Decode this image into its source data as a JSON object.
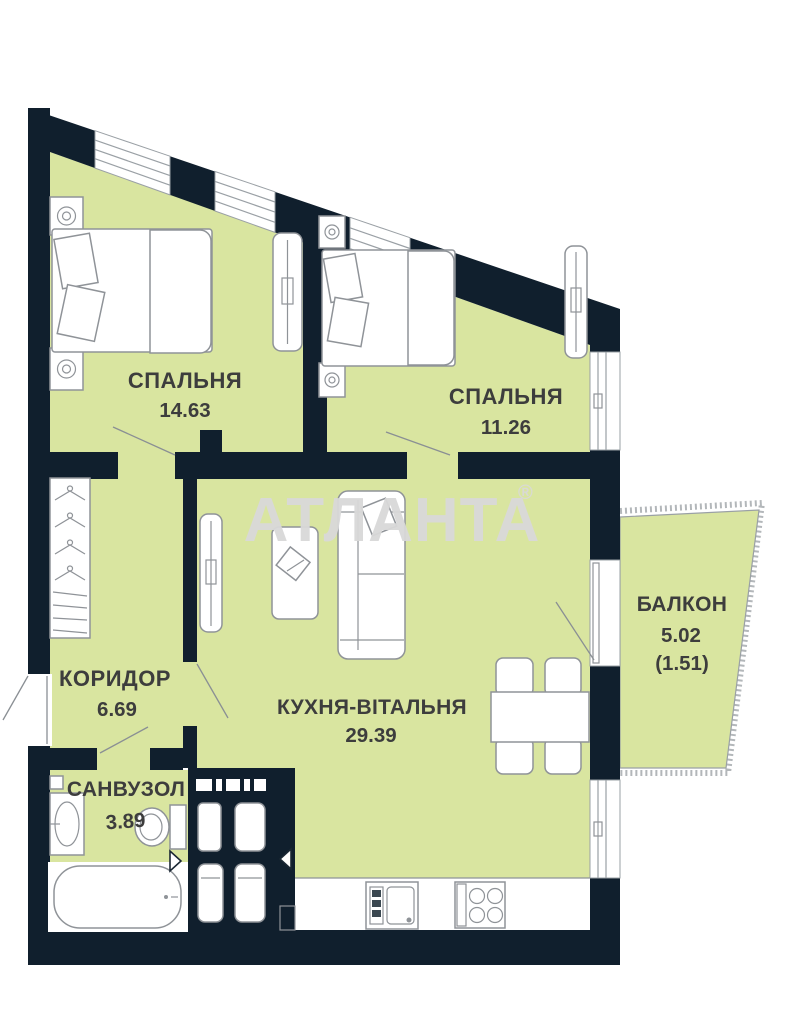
{
  "watermark": {
    "text": "АТЛАНТА",
    "symbol": "®"
  },
  "rooms": {
    "bedroom1": {
      "label": "СПАЛЬНЯ",
      "area": "14.63"
    },
    "bedroom2": {
      "label": "СПАЛЬНЯ",
      "area": "11.26"
    },
    "corridor": {
      "label": "КОРИДОР",
      "area": "6.69"
    },
    "kitchen": {
      "label": "КУХНЯ-ВІТАЛЬНЯ",
      "area": "29.39"
    },
    "bathroom": {
      "label": "САНВУЗОЛ",
      "area": "3.89"
    },
    "balcony": {
      "label": "БАЛКОН",
      "area": "5.02",
      "area_coefficient": "(1.51)"
    }
  },
  "colors": {
    "wall": "#101f2d",
    "floor": "#d9e5a0",
    "furniture_stroke": "#8f9398",
    "label_text": "#3d3d3d",
    "watermark": "#d9d9d9"
  }
}
